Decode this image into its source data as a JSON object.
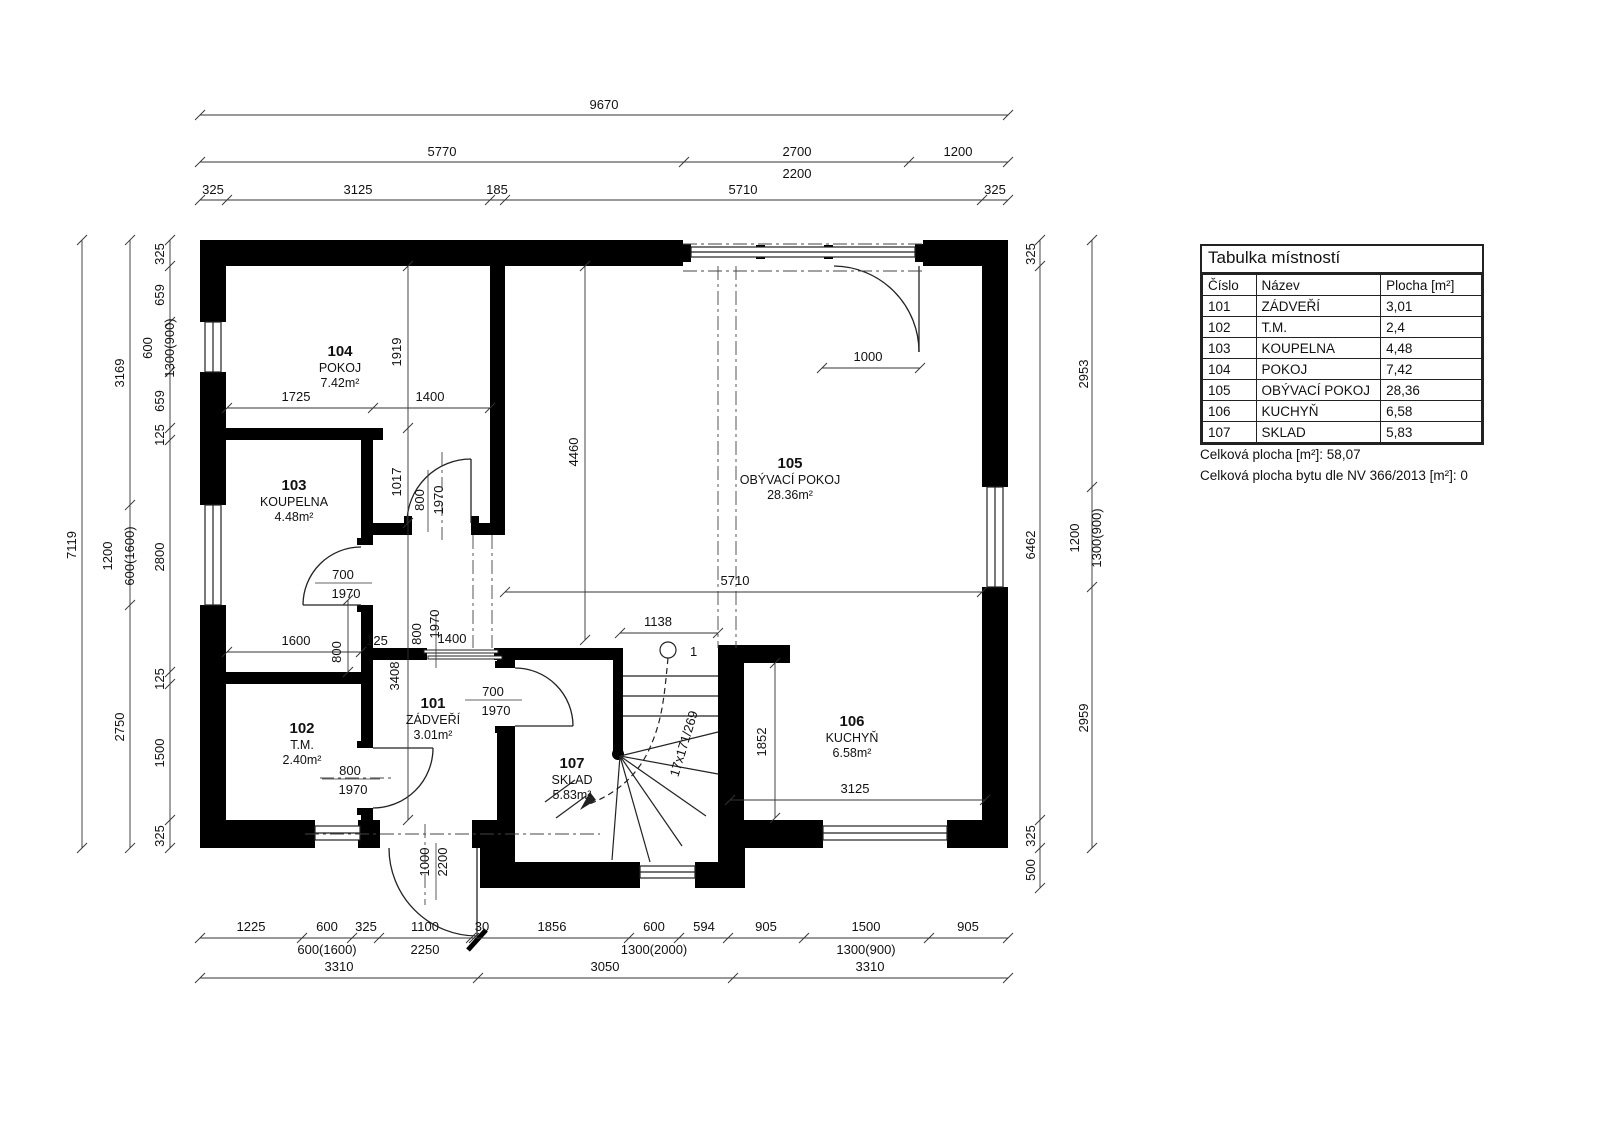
{
  "plan": {
    "rooms": [
      {
        "num": "101",
        "name": "ZÁDVEŘÍ",
        "area": "3.01m²"
      },
      {
        "num": "102",
        "name": "T.M.",
        "area": "2.40m²"
      },
      {
        "num": "103",
        "name": "KOUPELNA",
        "area": "4.48m²"
      },
      {
        "num": "104",
        "name": "POKOJ",
        "area": "7.42m²"
      },
      {
        "num": "105",
        "name": "OBÝVACÍ POKOJ",
        "area": "28.36m²"
      },
      {
        "num": "106",
        "name": "KUCHYŇ",
        "area": "6.58m²"
      },
      {
        "num": "107",
        "name": "SKLAD",
        "area": "5.83m²"
      }
    ],
    "stair": {
      "label": "17x171/269",
      "start": "1"
    },
    "dims": {
      "top": {
        "total": "9670",
        "seg1": "5770",
        "seg2": "2700",
        "seg2b": "2200",
        "seg3": "1200",
        "r3": [
          "325",
          "3125",
          "185",
          "5710",
          "325"
        ]
      },
      "left": {
        "total": "7119",
        "col2": [
          "3169",
          "1200",
          "2750"
        ],
        "win2": "600(1600)",
        "col3": [
          "325",
          "659",
          "600",
          "659",
          "125",
          "2800",
          "125",
          "1500",
          "325"
        ],
        "win3": "1300(900)"
      },
      "right": {
        "col1": [
          "325",
          "6462",
          "325",
          "500"
        ],
        "col2": [
          "2953",
          "1200",
          "2959"
        ],
        "win": "1300(900)"
      },
      "bottom": {
        "r1": [
          "1225",
          "600",
          "325",
          "1100",
          "30",
          "1856",
          "600",
          "594",
          "905",
          "1500",
          "905"
        ],
        "r1b": [
          "600(1600)",
          "2250",
          "1300(2000)",
          "1300(900)"
        ],
        "r2": [
          "3310",
          "3050",
          "3310"
        ]
      },
      "interior": {
        "i1919": "1919",
        "i1725": "1725",
        "i1400": "1400",
        "i1017": "1017",
        "i4460": "4460",
        "i5710": "5710",
        "i1138": "1138",
        "i1852": "1852",
        "i3125": "3125",
        "i1600": "1600",
        "i800": "800",
        "i125": "125",
        "i3408": "3408",
        "i1400b": "1400",
        "i1970b": "1970",
        "i800b": "800",
        "i1000": "1000"
      },
      "doors": {
        "d104": [
          "800",
          "1970"
        ],
        "d103": [
          "700",
          "1970"
        ],
        "d102": [
          "800",
          "1970"
        ],
        "d107": [
          "700",
          "1970"
        ],
        "entry": [
          "1000",
          "2200"
        ]
      }
    }
  },
  "table": {
    "title": "Tabulka místností",
    "columns": [
      "Číslo",
      "Název",
      "Plocha [m²]"
    ],
    "rows": [
      [
        "101",
        "ZÁDVEŘÍ",
        "3,01"
      ],
      [
        "102",
        "T.M.",
        "2,4"
      ],
      [
        "103",
        "KOUPELNA",
        "4,48"
      ],
      [
        "104",
        "POKOJ",
        "7,42"
      ],
      [
        "105",
        "OBÝVACÍ POKOJ",
        "28,36"
      ],
      [
        "106",
        "KUCHYŇ",
        "6,58"
      ],
      [
        "107",
        "SKLAD",
        "5,83"
      ]
    ],
    "total": "Celková plocha [m²]:  58,07",
    "total_nv": "Celková plocha bytu dle NV 366/2013 [m²]:  0"
  }
}
